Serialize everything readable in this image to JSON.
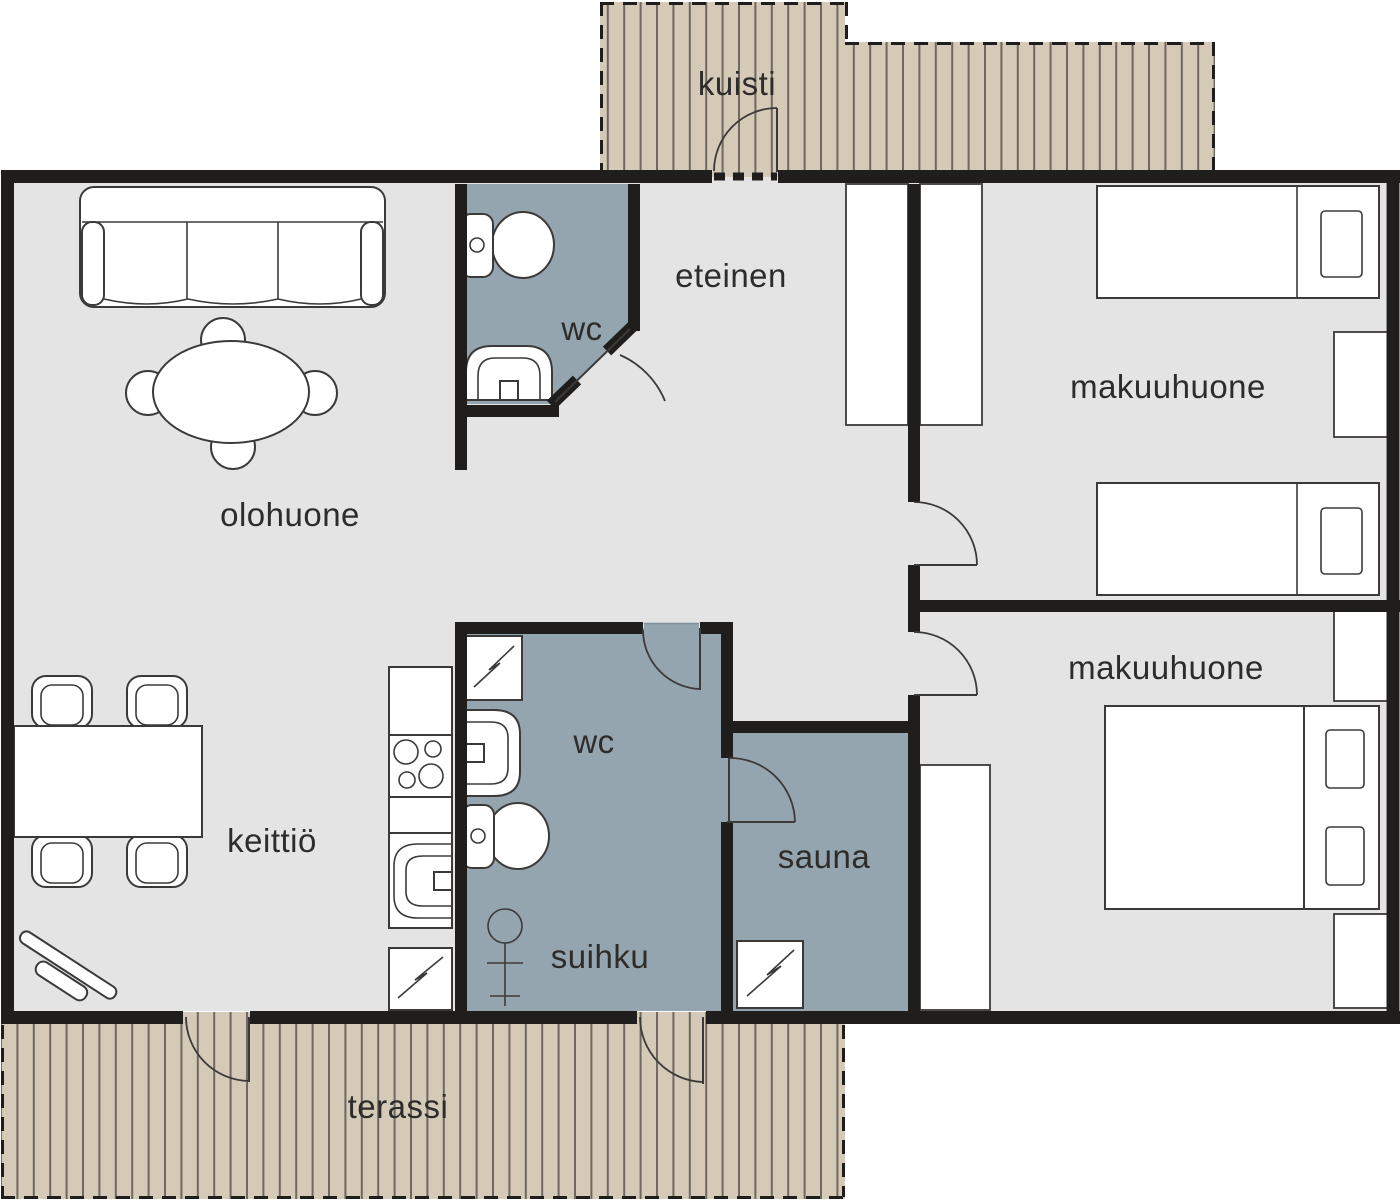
{
  "colors": {
    "background": "#ffffff",
    "floor": "#e4e4e5",
    "wall": "#201e1c",
    "wet_room": "#94a5af",
    "deck": "#d5c9b7",
    "deck_line": "#6e6860",
    "outline": "#3c3a38",
    "label": "#2e2c2a"
  },
  "rooms": {
    "kuisti": {
      "label": "kuisti"
    },
    "eteinen": {
      "label": "eteinen"
    },
    "wc_top": {
      "label": "wc"
    },
    "olohuone": {
      "label": "olohuone"
    },
    "makuuhuone_top": {
      "label": "makuuhuone"
    },
    "makuuhuone_bottom": {
      "label": "makuuhuone"
    },
    "keittio": {
      "label": "keittiö"
    },
    "wc_bottom": {
      "label": "wc"
    },
    "suihku": {
      "label": "suihku"
    },
    "sauna": {
      "label": "sauna"
    },
    "terassi": {
      "label": "terassi"
    }
  }
}
